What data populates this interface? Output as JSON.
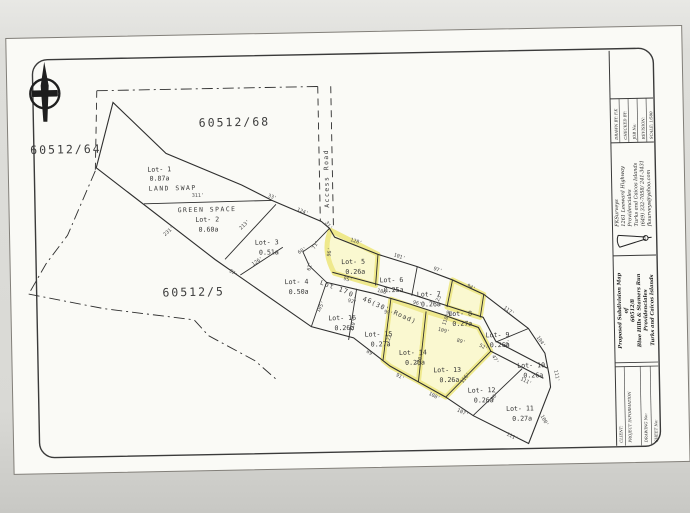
{
  "colors": {
    "paper": "#fafaf6",
    "backdrop": "#d8d8d4",
    "map_line": "#2e2e2e",
    "highlight_fill": "#faf8d0",
    "highlight_stroke": "#efe98c"
  },
  "parcels": {
    "west": "60512/64",
    "north": "60512/68",
    "south": "60512/5"
  },
  "map_labels": {
    "land_swap": "LAND SWAP",
    "green_space": "GREEN SPACE",
    "access_road": "Access Road",
    "road_lot": "Lot 17",
    "road_area": "0. 46",
    "road_name": "(30' Road)"
  },
  "lots": [
    {
      "name": "Lot- 1",
      "area": "0.87a"
    },
    {
      "name": "Lot- 2",
      "area": "0.60a"
    },
    {
      "name": "Lot- 3",
      "area": "0.51a"
    },
    {
      "name": "Lot- 4",
      "area": "0.50a"
    },
    {
      "name": "Lot- 5",
      "area": "0.26a"
    },
    {
      "name": "Lot- 6",
      "area": "0.25a"
    },
    {
      "name": "Lot- 7",
      "area": "0.26a"
    },
    {
      "name": "Lot- 8",
      "area": "0.27a"
    },
    {
      "name": "Lot- 9",
      "area": "0.26a"
    },
    {
      "name": "Lot- 10",
      "area": "0.26a"
    },
    {
      "name": "Lot- 11",
      "area": "0.27a"
    },
    {
      "name": "Lot- 12",
      "area": "0.26a"
    },
    {
      "name": "Lot- 13",
      "area": "0.26a"
    },
    {
      "name": "Lot- 14",
      "area": "0.26a"
    },
    {
      "name": "Lot- 15",
      "area": "0.27a"
    },
    {
      "name": "Lot- 16",
      "area": "0.26a"
    }
  ],
  "dims": [
    {
      "t": "311'"
    },
    {
      "t": "213'"
    },
    {
      "t": "231'"
    },
    {
      "t": "126'"
    },
    {
      "t": "33'"
    },
    {
      "t": "124'"
    },
    {
      "t": "31'"
    },
    {
      "t": "71'"
    },
    {
      "t": "60'"
    },
    {
      "t": "61'"
    },
    {
      "t": "97'"
    },
    {
      "t": "128'"
    },
    {
      "t": "101'"
    },
    {
      "t": "97'"
    },
    {
      "t": "94'"
    },
    {
      "t": "117'"
    },
    {
      "t": "104'"
    },
    {
      "t": "111'"
    },
    {
      "t": "100'"
    },
    {
      "t": "111'"
    },
    {
      "t": "107'"
    },
    {
      "t": "108'"
    },
    {
      "t": "91'"
    },
    {
      "t": "89'"
    },
    {
      "t": "95'"
    },
    {
      "t": "106'"
    },
    {
      "t": "96'"
    },
    {
      "t": "98'"
    },
    {
      "t": "92'"
    },
    {
      "t": "99'"
    },
    {
      "t": "109'"
    },
    {
      "t": "52'"
    },
    {
      "t": "47'"
    },
    {
      "t": "90'"
    },
    {
      "t": "118'"
    },
    {
      "t": "123'"
    },
    {
      "t": "122'"
    },
    {
      "t": "110'"
    },
    {
      "t": "105'"
    },
    {
      "t": "120'"
    },
    {
      "t": "116'"
    },
    {
      "t": "96'"
    },
    {
      "t": "111'"
    },
    {
      "t": "96'"
    },
    {
      "t": "89'"
    }
  ],
  "title_block": {
    "fields": [
      "DRAWN BY: F.K",
      "CHECKED BY:",
      "JOB No:",
      "REVISION:",
      "SCALE: 1/500"
    ],
    "company": [
      "FKSurveys",
      "1261 Leeward Highway",
      "Providenciales",
      "Turks and Caicos Islands",
      "(649) 332-7058/ 241-3431",
      "fksurveys@yahoo.com"
    ],
    "title": [
      "Proposed Subdivision Map",
      "of",
      "60512/8",
      "Blue Hills & Stamers Run",
      "Providenciales",
      "Turks and Caicos Islands"
    ],
    "client_label": "CLIENT:",
    "project_label": "PROJECT INFORMATION",
    "drawing_label": "DRAWING No:",
    "sheet_label": "SHEET No:"
  }
}
